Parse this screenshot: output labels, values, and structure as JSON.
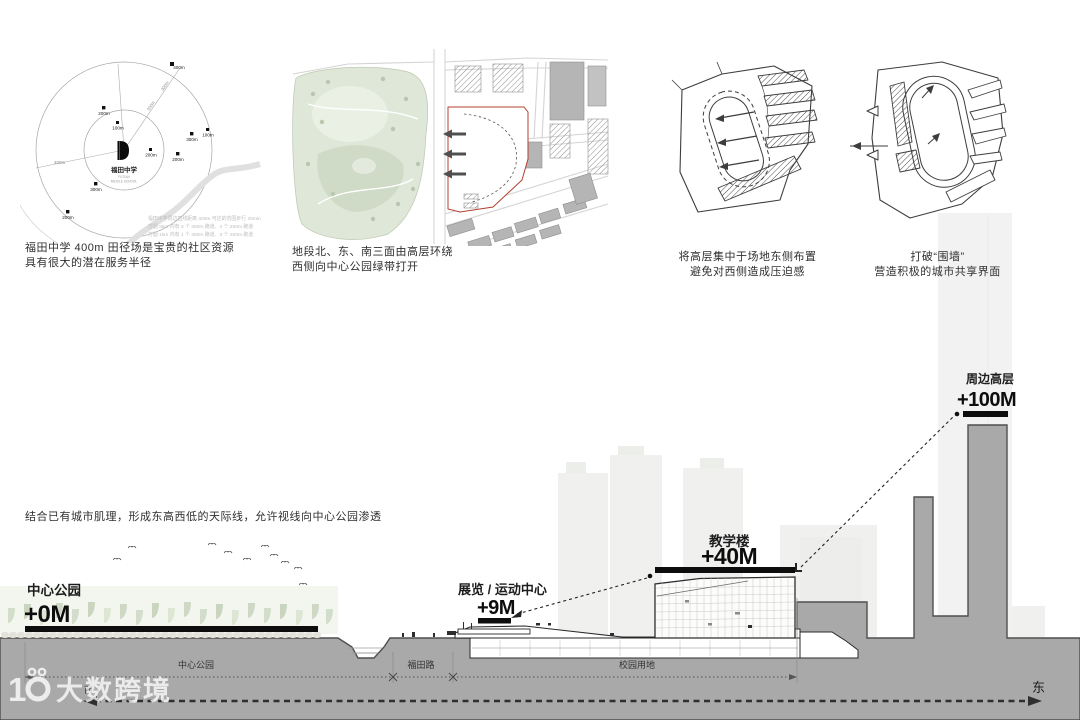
{
  "radial": {
    "center": {
      "name": "福田中学",
      "sub1": "FUTIAN",
      "sub2": "MIDDLE SCHOOL"
    },
    "ray_label": "400m",
    "west_label": "400m",
    "ray_ticks": [
      "200m",
      "300m"
    ],
    "markers": [
      {
        "label": "200m"
      },
      {
        "label": "100m"
      },
      {
        "label": "400m"
      },
      {
        "label": "300m"
      },
      {
        "label": "100m"
      },
      {
        "label": "200m"
      },
      {
        "label": "200m"
      },
      {
        "label": "300m"
      },
      {
        "label": "200m"
      }
    ],
    "note_lines": [
      "福田中学周边直线距离 400m 可达的范围步行 20min",
      "方圆 5km 内有 3 个 300m 跑道、4 个 250m 跑道",
      "方圆 1km 内有 1 个 300m 跑道、3 个 200m 跑道"
    ],
    "caption1": "福田中学 400m 田径场是宝贵的社区资源",
    "caption2": "具有很大的潜在服务半径"
  },
  "siteplan": {
    "caption1": "地段北、东、南三面由高层环绕",
    "caption2": "西侧向中心公园绿带打开"
  },
  "sketch1": {
    "caption1": "将高层集中于场地东侧布置",
    "caption2": "避免对西侧造成压迫感"
  },
  "sketch2": {
    "caption1": "打破“围墙”",
    "caption2": "营造积极的城市共享界面"
  },
  "section": {
    "note": "结合已有城市肌理，形成东高西低的天际线，允许视线向中心公园渗透",
    "park_label": "中心公园",
    "park_height": "+0M",
    "exhibit_label": "展览 / 运动中心",
    "exhibit_height": "+9M",
    "teach_label": "教学楼",
    "teach_height": "+40M",
    "tower_label": "周边高层",
    "tower_height": "+100M",
    "dim1": "中心公园",
    "dim2": "福田路",
    "dim3": "校园用地",
    "east": "东",
    "west": "西"
  },
  "watermark": {
    "text": "大数跨境"
  },
  "colors": {
    "ground": "#a9a9a9",
    "site_boundary": "#b2402f",
    "faded_building": "#f0f1ef"
  }
}
